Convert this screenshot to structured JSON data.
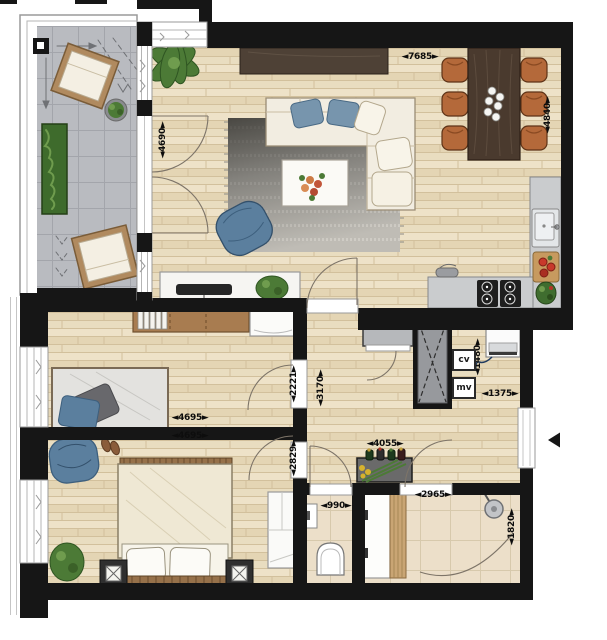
{
  "floor_plan": {
    "dims": {
      "living_width": "◄7685►",
      "living_depth": "◄4840►",
      "balcony_depth": "◄4690►",
      "bedroom1_width": "◄4695►",
      "bedroom2_width": "◄4695►",
      "bedroom1_entry": "◄2221►",
      "hall_depth": "◄3170►",
      "bedroom2_entry": "◄2829►",
      "tech_niche": "◄1480►",
      "entry_width": "◄1375►",
      "hall_width": "◄4055►",
      "wc_width": "◄990►",
      "bathroom_width": "◄2965►",
      "bathroom_depth": "◄1820►"
    },
    "tech_labels": {
      "cv": "cv",
      "mv": "mv"
    },
    "furniture": [
      "lounge-chair",
      "hedge-planter",
      "potted-plant",
      "sideboard",
      "dining-table",
      "dining-chair",
      "plates",
      "l-shaped-sofa",
      "throw-pillow",
      "rug",
      "coffee-table",
      "flower-bouquet",
      "armchair",
      "tv-cabinet",
      "tv",
      "kitchen-counter",
      "kitchen-sink",
      "cutting-board",
      "gas-hob",
      "kitchen-tap",
      "desk",
      "books",
      "dresser",
      "single-bed",
      "pillow",
      "double-bed",
      "nightstand",
      "bed-bench",
      "wardrobe",
      "washing-machine",
      "duct-shaft",
      "hall-closet",
      "console-table",
      "bottles",
      "toilet",
      "hand-basin",
      "vanity",
      "shower-head",
      "slippers",
      "entrance-door",
      "entrance-arrow"
    ],
    "colors": {
      "wall": "#161616",
      "wood_floor": "#e9ddc0",
      "balcony_tile": "#b9bbc0",
      "bath_tile": "#ecdfc9",
      "counter_grey": "#caccce",
      "accent_blue": "#5b7f9e",
      "dark_wood": "#4a3a2e",
      "chair_leather": "#b4693a",
      "plant_green": "#4c7a36",
      "cream": "#f2ede1"
    }
  }
}
